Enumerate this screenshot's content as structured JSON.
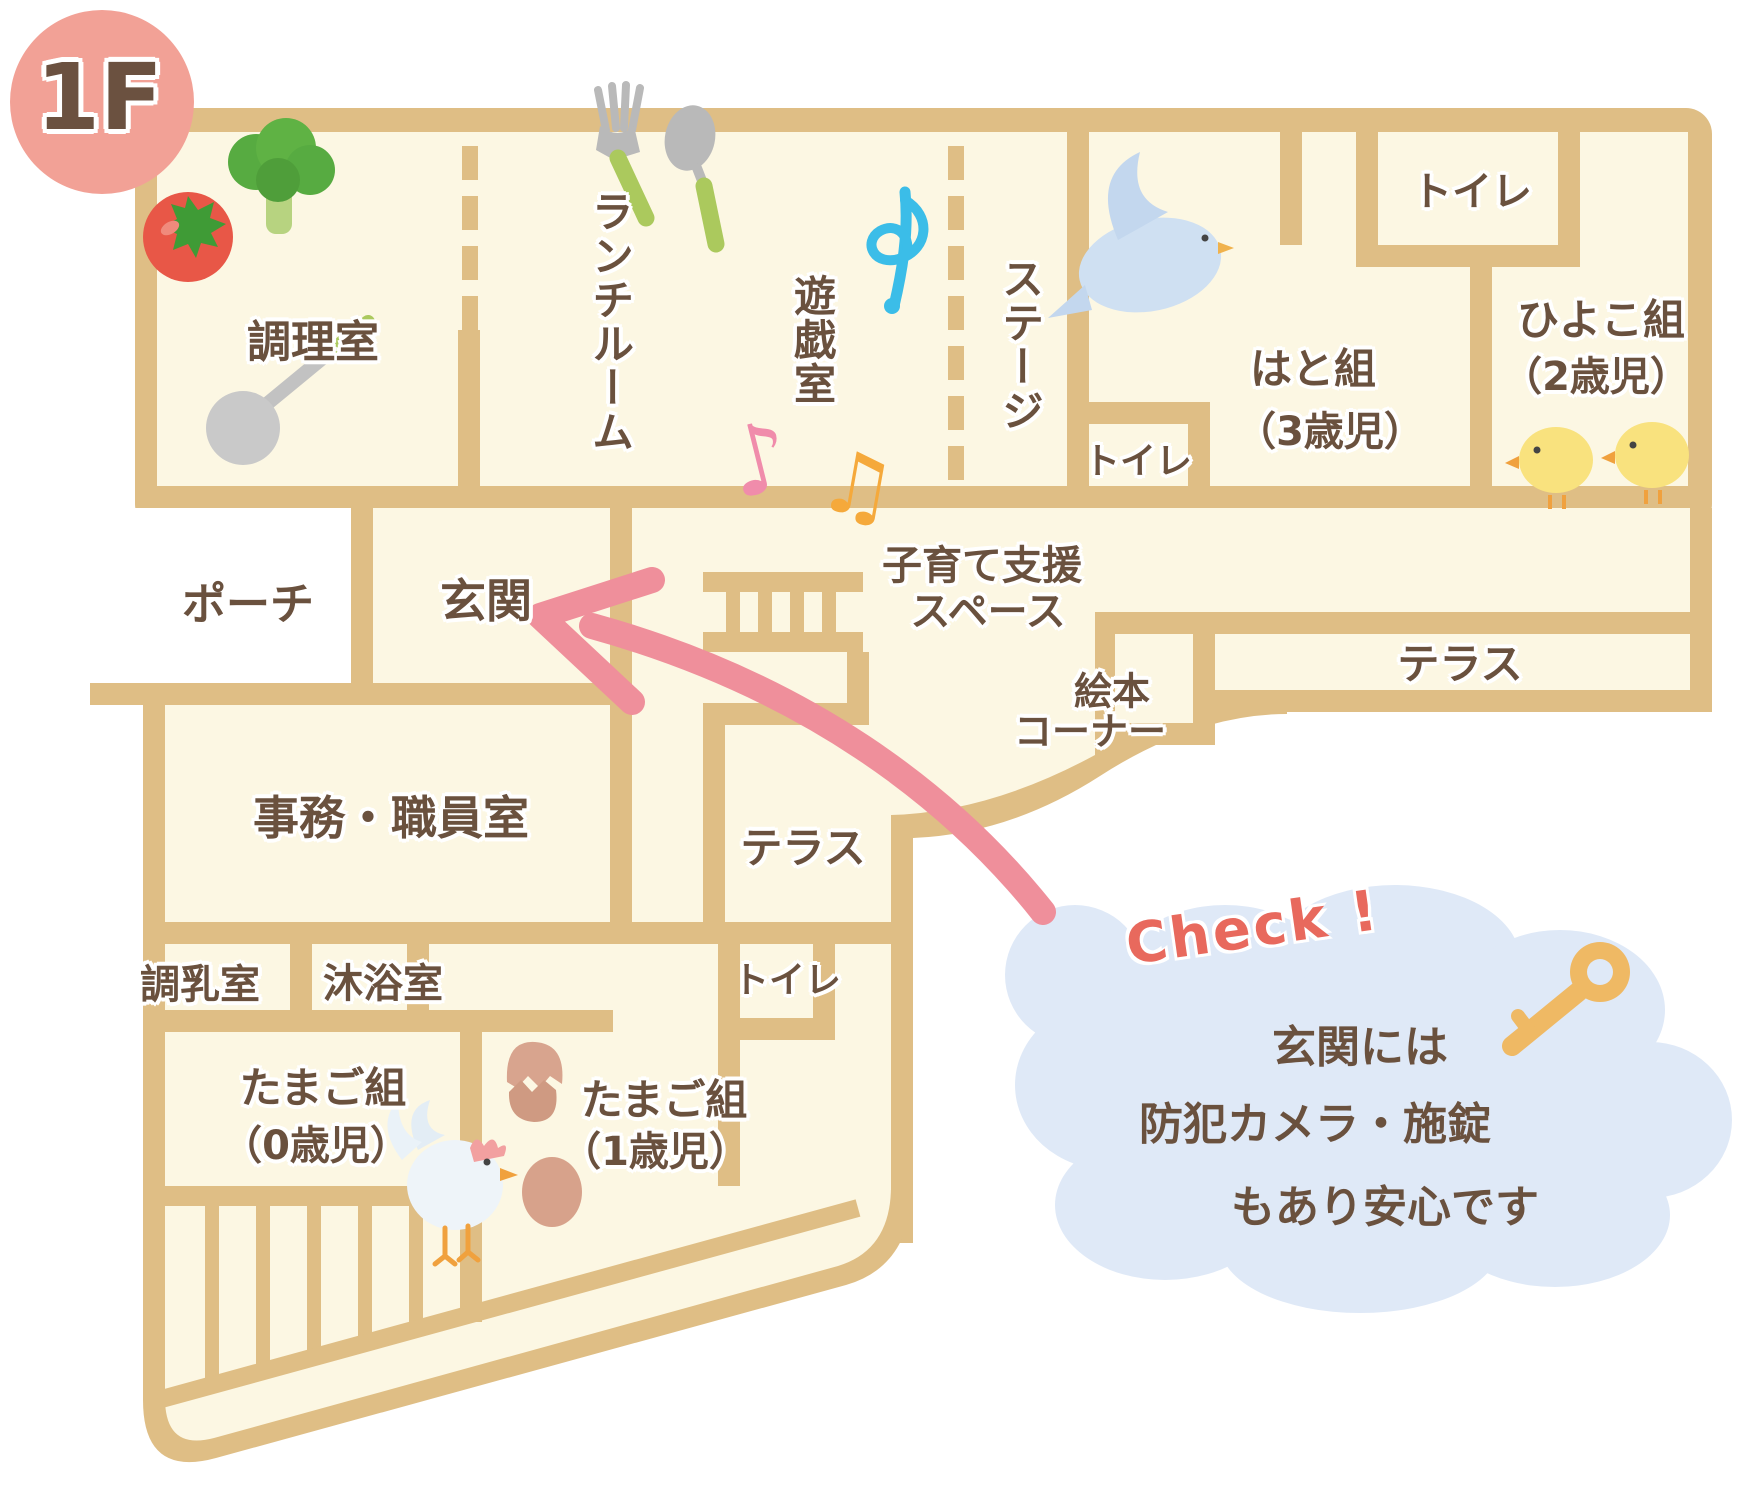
{
  "floor_badge": {
    "label": "1F"
  },
  "plan": {
    "rooms": {
      "kitchen": {
        "label": "調理室"
      },
      "lunch_room": {
        "label": "ランチルーム"
      },
      "play_room": {
        "label": "遊戯室"
      },
      "stage": {
        "label": "ステージ"
      },
      "toilet_center": {
        "label": "トイレ"
      },
      "hato_class": {
        "label": "はと組",
        "age": "（3歳児）"
      },
      "toilet_north": {
        "label": "トイレ"
      },
      "hiyoko_class": {
        "label": "ひよこ組",
        "age": "（2歳児）"
      },
      "porch": {
        "label": "ポーチ"
      },
      "entrance": {
        "label": "玄関"
      },
      "support_space": {
        "line1": "子育て支援",
        "line2": "スペース"
      },
      "picture_book_corner": {
        "line1": "絵本",
        "line2": "コーナー"
      },
      "terrace_east": {
        "label": "テラス"
      },
      "office": {
        "label": "事務・職員室"
      },
      "terrace_center": {
        "label": "テラス"
      },
      "milk_prep_room": {
        "label": "調乳室"
      },
      "baby_bath_room": {
        "label": "沐浴室"
      },
      "toilet_south": {
        "label": "トイレ"
      },
      "tamago_class_0": {
        "label": "たまご組",
        "age": "（0歳児）"
      },
      "tamago_class_1": {
        "label": "たまご組",
        "age": "（1歳児）"
      }
    },
    "callout": {
      "check": "Check !",
      "line1": "玄関には",
      "line2": "防犯カメラ・施錠",
      "line3": "もあり安心です"
    },
    "icons": [
      "tomato-icon",
      "broccoli-icon",
      "ladle-icon",
      "fork-icon",
      "spoon-icon",
      "treble-clef-icon",
      "music-note-pink-icon",
      "music-note-orange-icon",
      "dove-icon",
      "chick-icon",
      "rooster-icon",
      "egg-cracked-icon",
      "egg-icon",
      "stairs-icon",
      "key-icon",
      "arrow-to-entrance"
    ],
    "colors": {
      "wall": "#dfbe85",
      "room": "#fcf7e3",
      "text": "#6a513e",
      "badge": "#f2a196",
      "check_accent": "#e8695d",
      "cloud": "#dfe9f7",
      "arrow": "#ef8f9b",
      "key": "#efb964"
    }
  }
}
